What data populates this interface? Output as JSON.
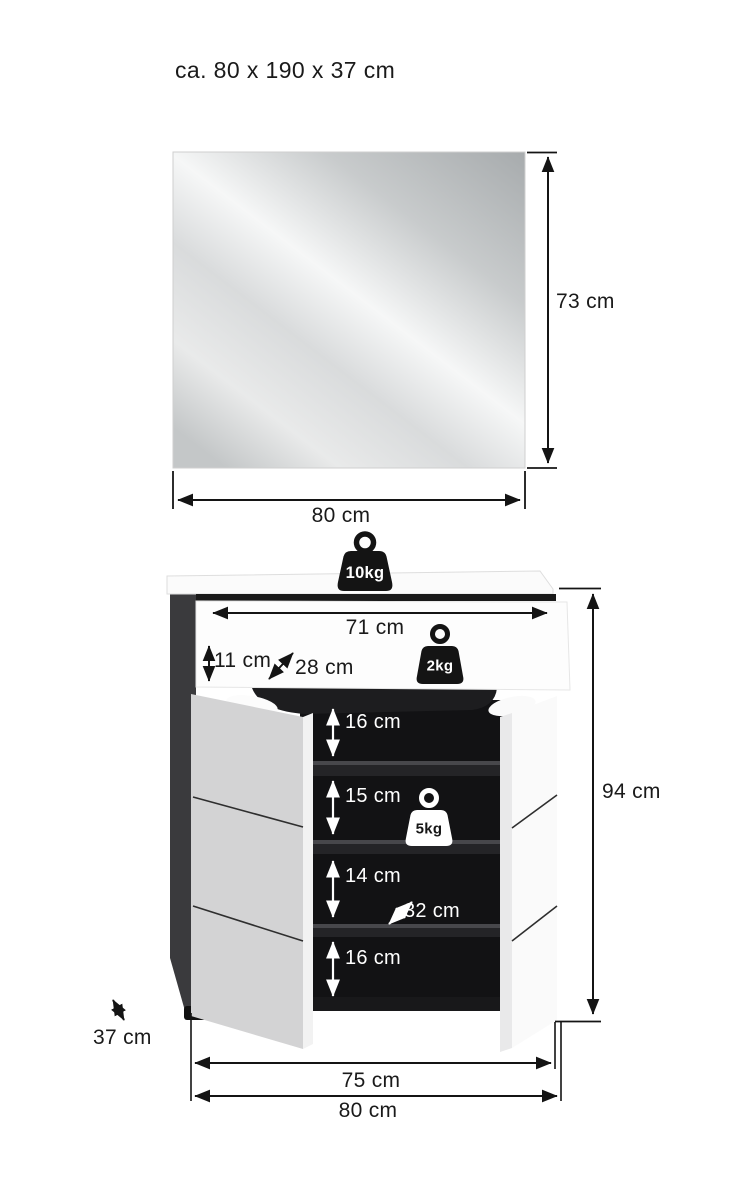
{
  "title": "ca. 80 x 190 x 37 cm",
  "mirror": {
    "height_label": "73 cm",
    "width_label": "80 cm"
  },
  "cabinet": {
    "top_load_label": "10kg",
    "drawer_load_label": "2kg",
    "shelf_load_label": "5kg",
    "inner_width_label": "71 cm",
    "drawer_height_label": "11 cm",
    "drawer_depth_label": "28 cm",
    "height_label": "94 cm",
    "depth_label": "37 cm",
    "front_width_label": "75 cm",
    "total_width_label": "80 cm",
    "shelf_depth_label": "32 cm",
    "shelf_labels": [
      "16 cm",
      "15 cm",
      "14 cm",
      "16 cm"
    ]
  },
  "colors": {
    "line": "#141414",
    "interior_black": "#121214",
    "side_panel_dark": "#3a3a3d",
    "door_gray": "#d3d3d4",
    "door_white": "#fafafa",
    "white_marks": "#ffffff"
  }
}
